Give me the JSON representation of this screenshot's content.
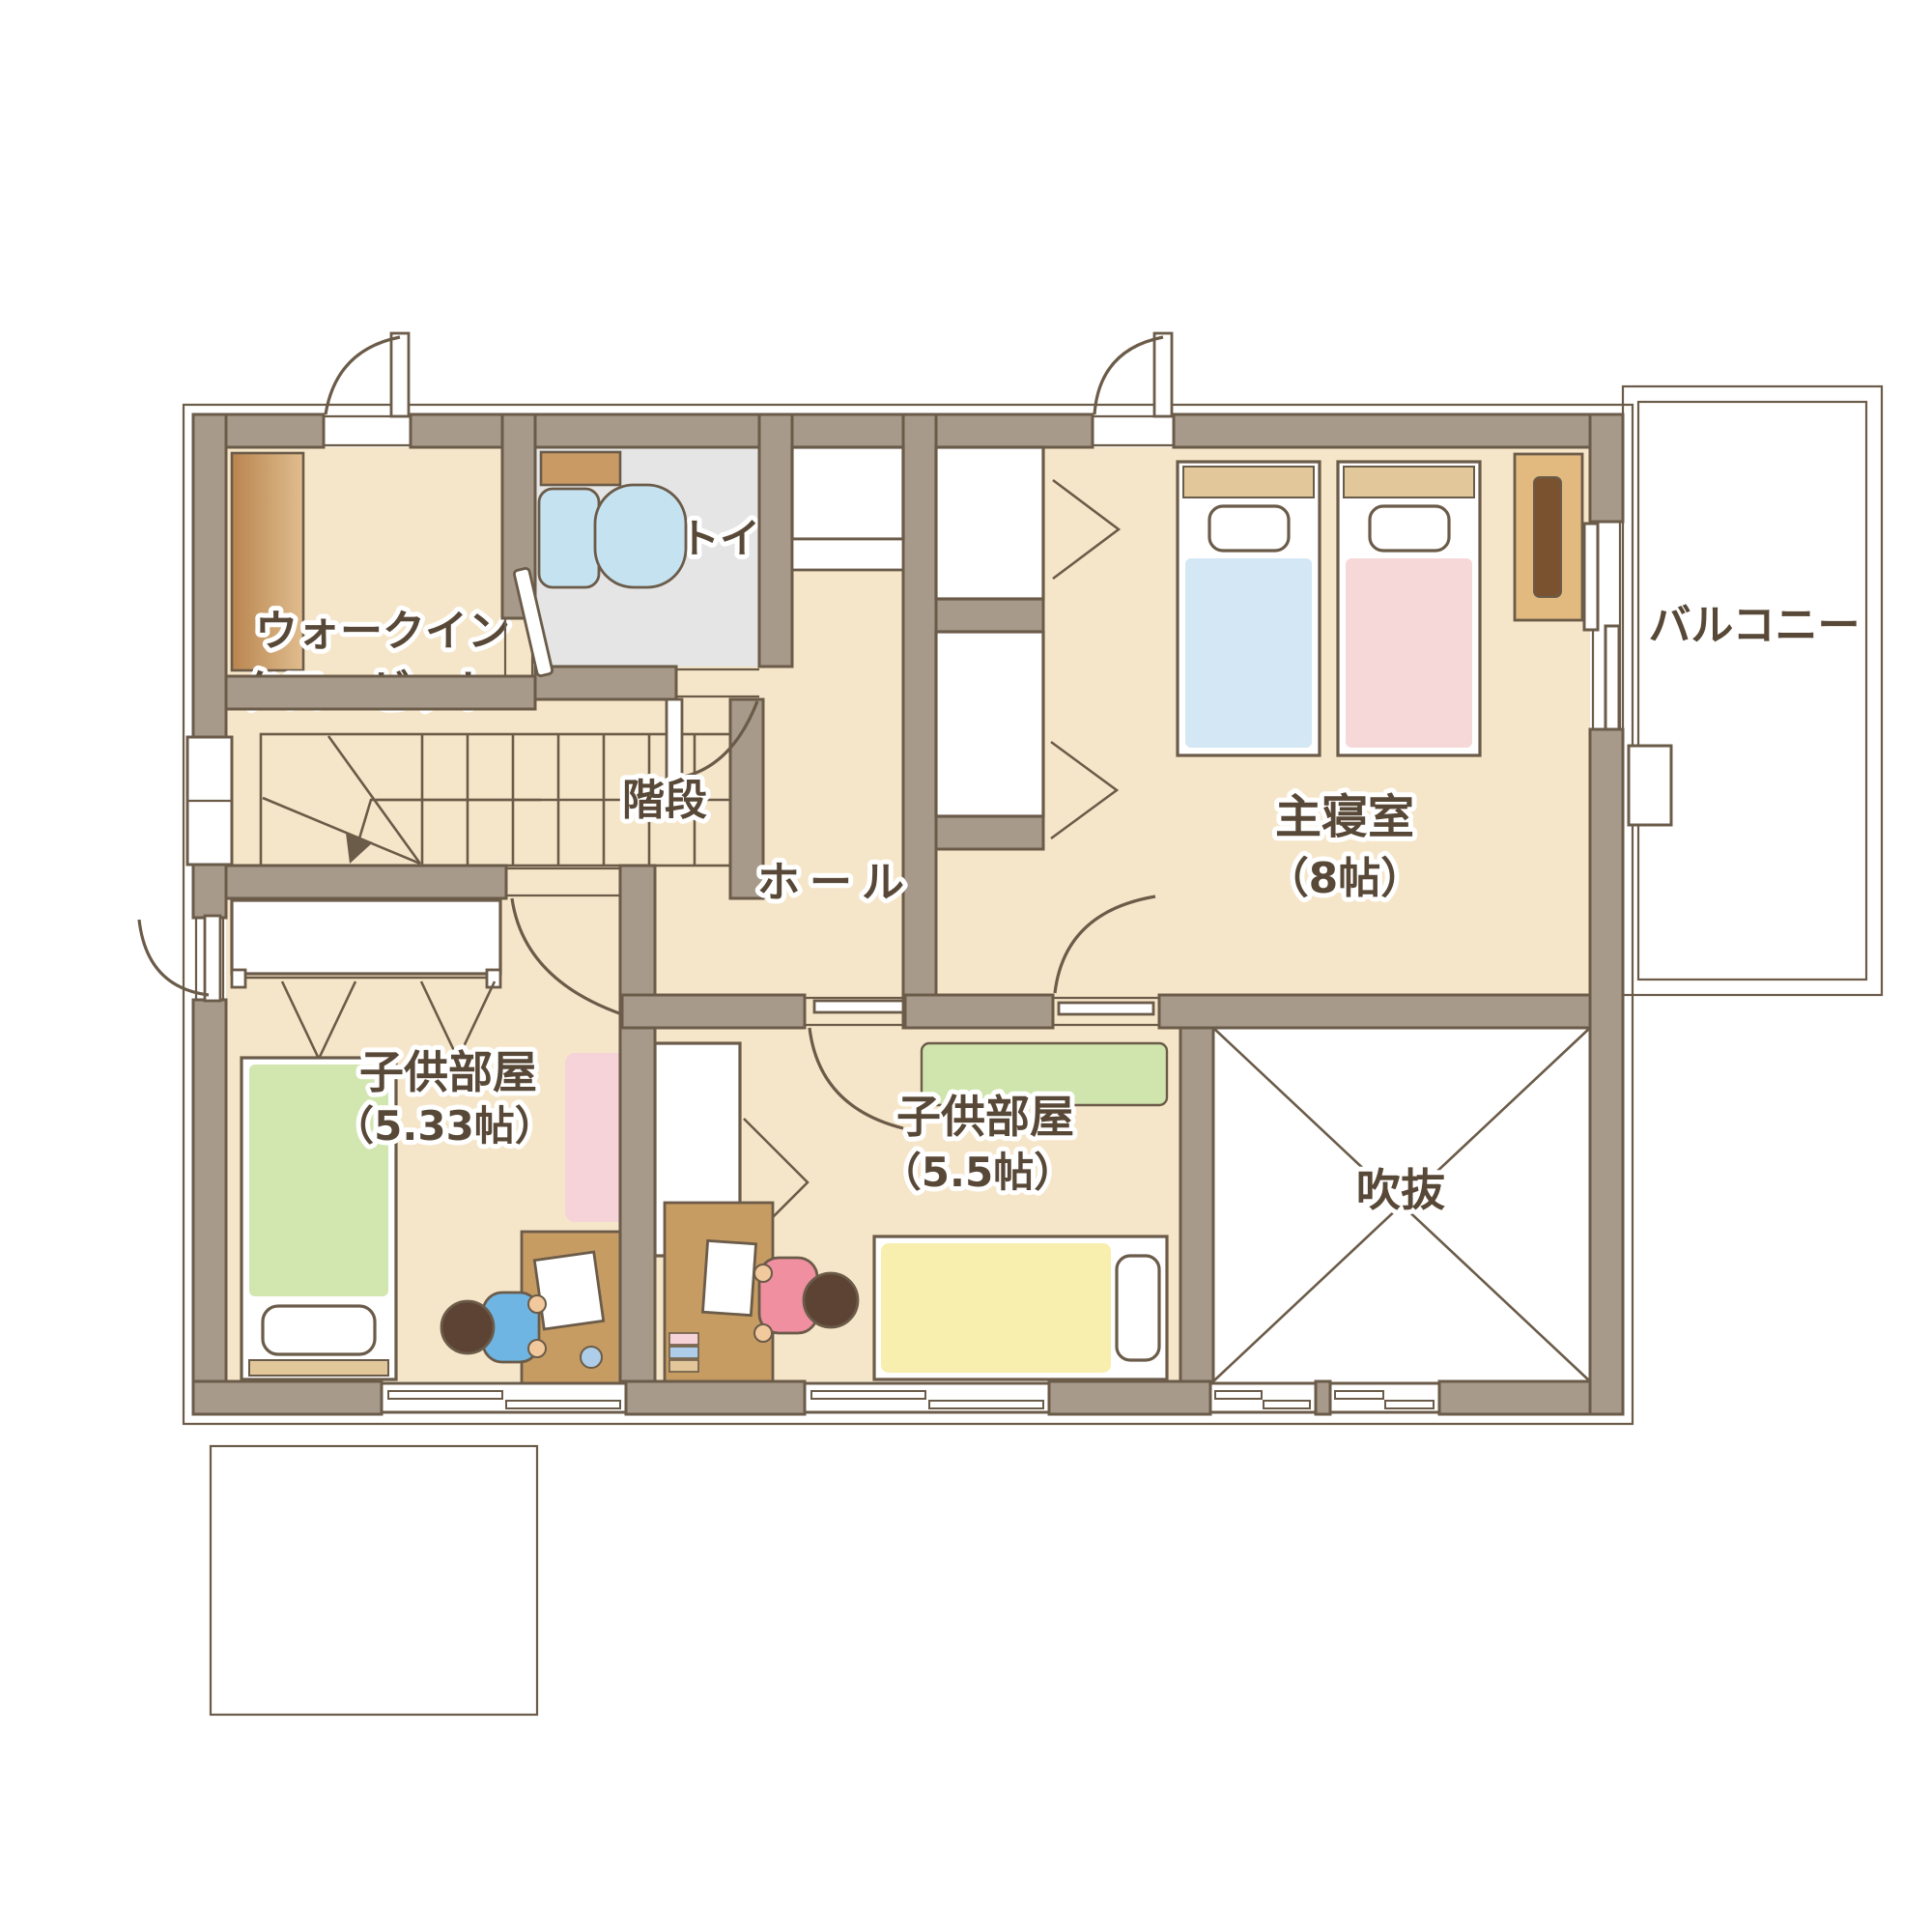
{
  "title": "2階 間取り図（2F floor plan illustration）",
  "rooms": {
    "wic": {
      "line1": "ウォークイン",
      "line2": "クローゼット"
    },
    "toilet": {
      "label": "トイレ"
    },
    "stairs": {
      "label": "階段"
    },
    "hall": {
      "label": "ホール"
    },
    "master": {
      "label": "主寝室",
      "size": "（8帖）"
    },
    "balcony": {
      "label": "バルコニー"
    },
    "kids_left": {
      "label": "子供部屋",
      "size": "（5.33帖）"
    },
    "kids_right": {
      "label": "子供部屋",
      "size": "（5.5帖）"
    },
    "void": {
      "label": "吹抜"
    }
  },
  "colors": {
    "wall": "#a79a8b",
    "wall_line": "#6b5b49",
    "floor": "#f6e6c9",
    "toilet_floor": "#e4e5e4",
    "stairs": "#ece0a2",
    "balcony_floor": "#e9e9e7",
    "bed_blue": "#d3e7f5",
    "bed_pink": "#f7d8d9",
    "bed_green": "#d2e6b0",
    "bed_yellow": "#f8eeae",
    "rug_pink": "#f6d3d8",
    "rug_green": "#cfe5ad",
    "desk": "#c69c63",
    "wood": "#c99a64",
    "wood_dark": "#7a5230",
    "headboard": "#e2c79a",
    "toilet_fixture": "#c5e2f0",
    "text": "#584837",
    "kid_hair": "#5d4334",
    "kid_skin": "#f2c99c",
    "shirt_blue": "#6fb5e3",
    "shirt_pink": "#ef8f9f"
  }
}
